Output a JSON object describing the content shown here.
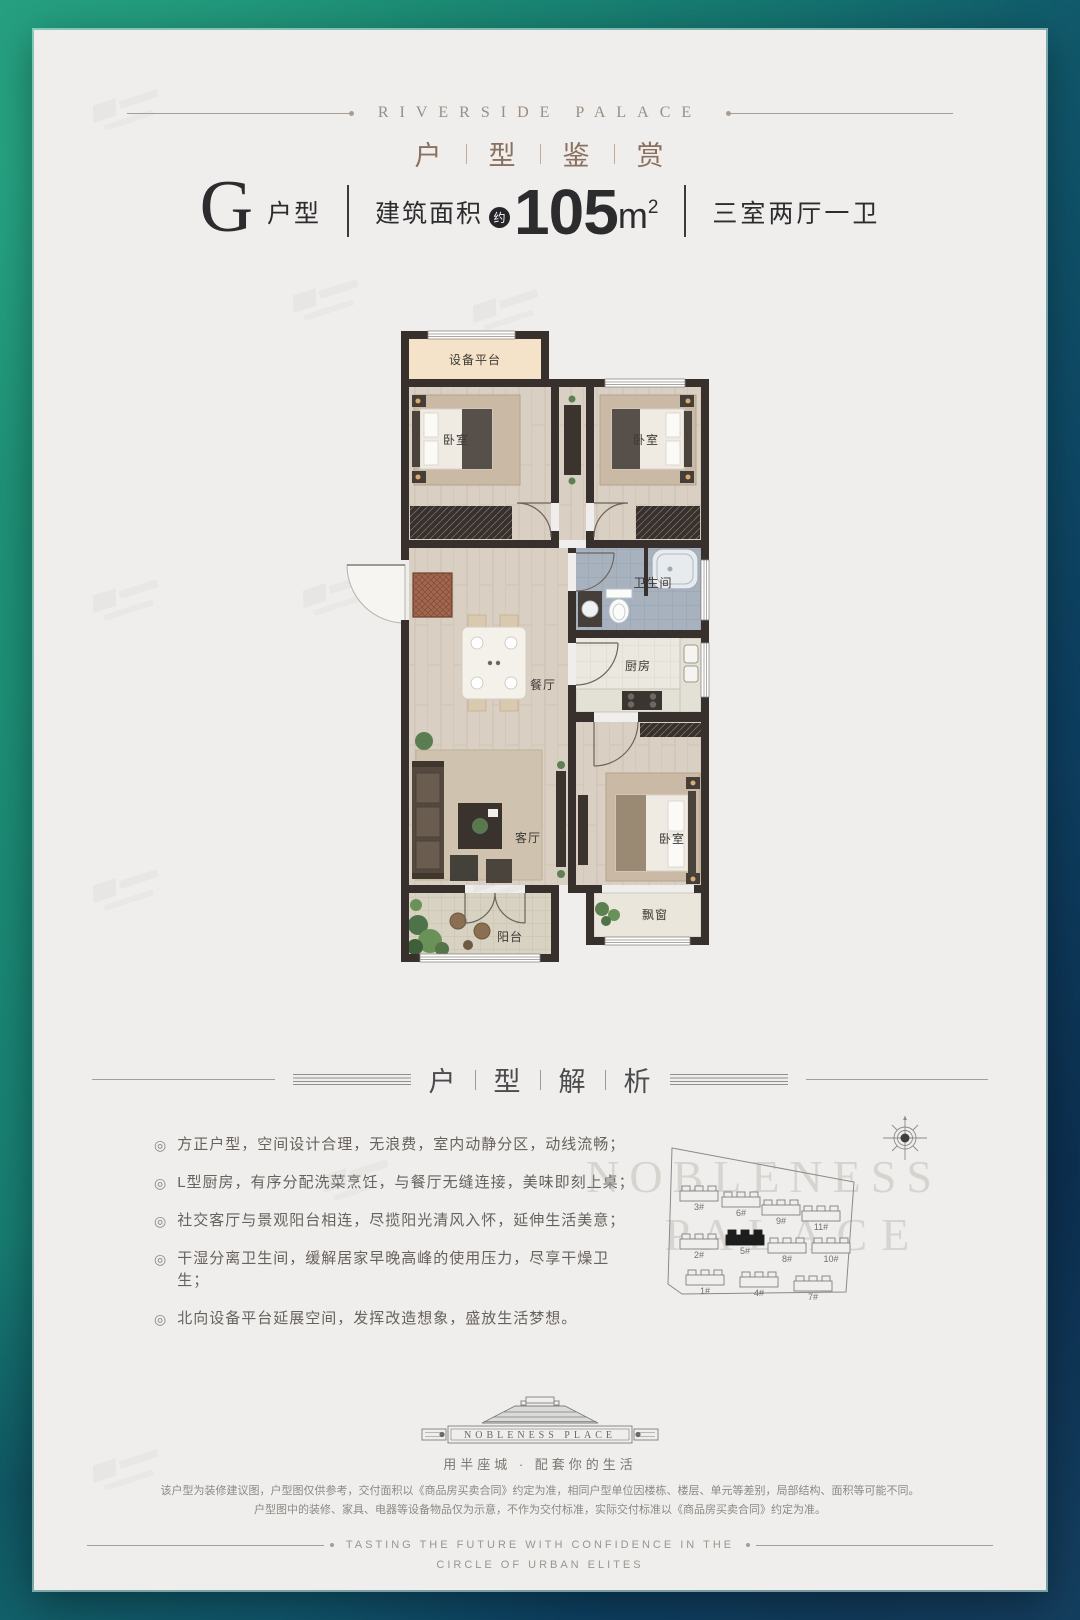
{
  "colors": {
    "background_teal": "#1f9379",
    "background_navy": "#0f3a5c",
    "card": "#efeeec",
    "brand_brown": "#8b7060",
    "title_ink": "#2c2c2e",
    "plan_wall": "#37302c",
    "bath_tile": "#a7b2be",
    "equipment_beige": "#f4e3c8",
    "wood_floor": "#d9cfc3",
    "plant_green": "#5c7d52"
  },
  "header": {
    "brand": "RIVERSIDE PALACE",
    "section_title_chars": [
      "户",
      "型",
      "鉴",
      "赏"
    ]
  },
  "unit_bar": {
    "type_letter": "G",
    "type_label": "户型",
    "area_label": "建筑面积",
    "approx_badge": "约",
    "area_value": "105",
    "area_unit": "m",
    "area_exponent": "2",
    "rooms_summary": "三室两厅一卫"
  },
  "floor_plan": {
    "equipment_platform": "设备平台",
    "bedroom_top_left": "卧室",
    "bedroom_top_right": "卧室",
    "bathroom": "卫生间",
    "kitchen": "厨房",
    "dining": "餐厅",
    "living": "客厅",
    "bedroom_master": "卧室",
    "balcony": "阳台",
    "bay_window": "飘窗"
  },
  "analysis": {
    "section_title_chars": [
      "户",
      "型",
      "解",
      "析"
    ],
    "bullet_marker": "◎",
    "bullets": [
      "方正户型，空间设计合理，无浪费，室内动静分区，动线流畅；",
      "L型厨房，有序分配洗菜烹饪，与餐厅无缝连接，美味即刻上桌；",
      "社交客厅与景观阳台相连，尽揽阳光清风入怀，延伸生活美意；",
      "干湿分离卫生间，缓解居家早晚高峰的使用压力，尽享干燥卫生；",
      "北向设备平台延展空间，发挥改造想象，盛放生活梦想。"
    ]
  },
  "site_map": {
    "buildings": [
      {
        "label": "3#"
      },
      {
        "label": "6#"
      },
      {
        "label": "9#"
      },
      {
        "label": "11#"
      },
      {
        "label": "2#"
      },
      {
        "label": "5#"
      },
      {
        "label": "8#"
      },
      {
        "label": "10#"
      },
      {
        "label": "1#"
      },
      {
        "label": "4#"
      },
      {
        "label": "7#"
      }
    ],
    "highlighted": "5#",
    "watermark_top": "NOBLENESS",
    "watermark_bottom": "PALACE"
  },
  "logo": {
    "name_text": "NOBLENESS PLACE",
    "slogan": "用半座城 · 配套你的生活"
  },
  "disclaimer": {
    "line1": "该户型为装修建议图，户型图仅供参考，交付面积以《商品房买卖合同》约定为准，相同户型单位因楼栋、楼层、单元等差别，局部结构、面积等可能不同。",
    "line2": "户型图中的装修、家具、电器等设备物品仅为示意，不作为交付标准，实际交付标准以《商品房买卖合同》约定为准。"
  },
  "footer": {
    "line1": "TASTING THE FUTURE WITH CONFIDENCE IN THE",
    "line2": "CIRCLE OF URBAN ELITES"
  }
}
